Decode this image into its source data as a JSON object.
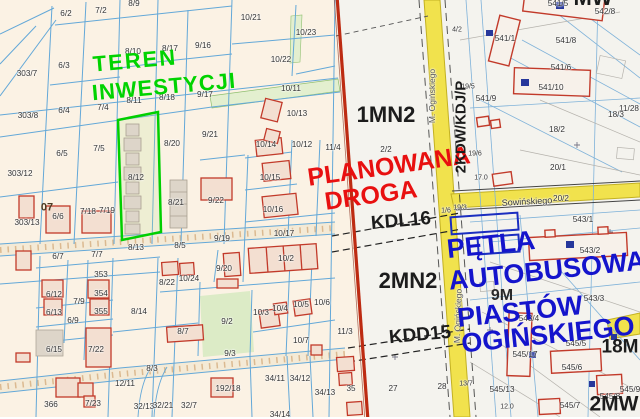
{
  "map": {
    "description": "Cadastral parcel map with zoning plan overlay",
    "colors": {
      "investment_green": "#00d300",
      "planned_road_red": "#e81010",
      "bus_loop_blue": "#1414cc",
      "road_yellow": "#f1e24d",
      "plan_boundary_red": "#bd2b12",
      "parcel_line_blue": "#63a8d8",
      "building_outline_red": "#c23a2a",
      "highlight_parcel_green": "#00cf00",
      "left_background": "#fbf2e4",
      "right_background": "#f4f3ee"
    }
  },
  "labels": {
    "zones": [
      {
        "t": "TEREN",
        "x": 135,
        "y": 61,
        "s": 22,
        "c": "#00d300",
        "r": -5,
        "b": 1,
        "ls": 2
      },
      {
        "t": "INWESTYCJI",
        "x": 164,
        "y": 87,
        "s": 22,
        "c": "#00d300",
        "r": -5,
        "b": 1,
        "ls": 1
      },
      {
        "t": "PLANOWANA",
        "x": 389,
        "y": 167,
        "s": 25,
        "c": "#e81010",
        "r": -8,
        "b": 1
      },
      {
        "t": "DROGA",
        "x": 371,
        "y": 196,
        "s": 25,
        "c": "#e81010",
        "r": -8,
        "b": 1
      },
      {
        "t": "PĘTLA",
        "x": 491,
        "y": 245,
        "s": 27,
        "c": "#1414cc",
        "r": -6,
        "b": 1
      },
      {
        "t": "AUTOBUSOWA",
        "x": 547,
        "y": 271,
        "s": 27,
        "c": "#1414cc",
        "r": -6,
        "b": 1
      },
      {
        "t": "PIASTÓW",
        "x": 520,
        "y": 312,
        "s": 27,
        "c": "#1414cc",
        "r": -6,
        "b": 1
      },
      {
        "t": "OGIŃSKIEGO",
        "x": 548,
        "y": 335,
        "s": 27,
        "c": "#1414cc",
        "r": -6,
        "b": 1
      },
      {
        "t": "1MN2",
        "x": 386,
        "y": 115,
        "s": 22,
        "c": "#1c1c1c",
        "b": 1
      },
      {
        "t": "2MN2",
        "x": 408,
        "y": 281,
        "s": 22,
        "c": "#1c1c1c",
        "b": 1
      },
      {
        "t": "KDL16",
        "x": 401,
        "y": 221,
        "s": 19,
        "c": "#1c1c1c",
        "r": -5,
        "b": 1
      },
      {
        "t": "KDD15",
        "x": 420,
        "y": 335,
        "s": 19,
        "c": "#1c1c1c",
        "r": -5,
        "b": 1
      },
      {
        "t": "2KDW/KDJ/P",
        "x": 461,
        "y": 127,
        "s": 15,
        "c": "#1c1c1c",
        "r": -90,
        "b": 1
      },
      {
        "t": "9M",
        "x": 502,
        "y": 296,
        "s": 16,
        "c": "#2a2a2a",
        "b": 1
      },
      {
        "t": "18M",
        "x": 620,
        "y": 347,
        "s": 19,
        "c": "#1c1c1c",
        "b": 1
      },
      {
        "t": "2MW",
        "x": 614,
        "y": 404,
        "s": 21,
        "c": "#1c1c1c",
        "b": 1
      },
      {
        "t": "MW",
        "x": 593,
        "y": -2,
        "s": 22,
        "c": "#1c1c1c",
        "b": 1
      },
      {
        "t": "07",
        "x": 47,
        "y": 208,
        "s": 11,
        "c": "#4a3a22",
        "b": 1
      }
    ],
    "streets": [
      {
        "t": "M. Ogińskiego",
        "x": 432,
        "y": 96,
        "r": -90,
        "s": 8.5,
        "c": "#555555"
      },
      {
        "t": "M. Ogińskiego",
        "x": 458,
        "y": 316,
        "r": -88,
        "s": 8.5,
        "c": "#555555"
      },
      {
        "t": "Sowińskiego",
        "x": 527,
        "y": 202,
        "r": -3,
        "s": 9,
        "c": "#333333"
      }
    ],
    "parcels": [
      {
        "t": "6/2",
        "x": 66,
        "y": 14
      },
      {
        "t": "7/2",
        "x": 101,
        "y": 11
      },
      {
        "t": "8/9",
        "x": 134,
        "y": 4
      },
      {
        "t": "303/7",
        "x": 27,
        "y": 74
      },
      {
        "t": "6/3",
        "x": 64,
        "y": 66
      },
      {
        "t": "8/10",
        "x": 133,
        "y": 52
      },
      {
        "t": "8/17",
        "x": 170,
        "y": 49
      },
      {
        "t": "9/16",
        "x": 203,
        "y": 46
      },
      {
        "t": "10/21",
        "x": 251,
        "y": 18
      },
      {
        "t": "10/23",
        "x": 306,
        "y": 33
      },
      {
        "t": "10/22",
        "x": 281,
        "y": 60
      },
      {
        "t": "303/8",
        "x": 28,
        "y": 116
      },
      {
        "t": "6/4",
        "x": 64,
        "y": 111
      },
      {
        "t": "7/4",
        "x": 103,
        "y": 108
      },
      {
        "t": "8/11",
        "x": 134,
        "y": 101
      },
      {
        "t": "8/18",
        "x": 167,
        "y": 98
      },
      {
        "t": "9/17",
        "x": 205,
        "y": 95
      },
      {
        "t": "10/11",
        "x": 291,
        "y": 89
      },
      {
        "t": "10/13",
        "x": 297,
        "y": 114
      },
      {
        "t": "303/12",
        "x": 20,
        "y": 174
      },
      {
        "t": "6/5",
        "x": 62,
        "y": 154
      },
      {
        "t": "7/5",
        "x": 99,
        "y": 149
      },
      {
        "t": "8/12",
        "x": 136,
        "y": 178
      },
      {
        "t": "9/21",
        "x": 210,
        "y": 135
      },
      {
        "t": "10/14",
        "x": 266,
        "y": 145
      },
      {
        "t": "10/12",
        "x": 302,
        "y": 145
      },
      {
        "t": "11/4",
        "x": 333,
        "y": 148
      },
      {
        "t": "8/20",
        "x": 172,
        "y": 144
      },
      {
        "t": "6/6",
        "x": 58,
        "y": 217
      },
      {
        "t": "303/13",
        "x": 27,
        "y": 223
      },
      {
        "t": "7/18",
        "x": 88,
        "y": 212
      },
      {
        "t": "7/19",
        "x": 107,
        "y": 211
      },
      {
        "t": "8/21",
        "x": 176,
        "y": 203
      },
      {
        "t": "9/22",
        "x": 216,
        "y": 201
      },
      {
        "t": "10/15",
        "x": 270,
        "y": 178
      },
      {
        "t": "10/16",
        "x": 273,
        "y": 210
      },
      {
        "t": "8/13",
        "x": 136,
        "y": 248
      },
      {
        "t": "6/7",
        "x": 58,
        "y": 257
      },
      {
        "t": "7/7",
        "x": 97,
        "y": 255
      },
      {
        "t": "353",
        "x": 101,
        "y": 275
      },
      {
        "t": "10/17",
        "x": 284,
        "y": 234
      },
      {
        "t": "9/19",
        "x": 222,
        "y": 239
      },
      {
        "t": "8/5",
        "x": 180,
        "y": 246
      },
      {
        "t": "9/20",
        "x": 224,
        "y": 269
      },
      {
        "t": "10/2",
        "x": 286,
        "y": 259
      },
      {
        "t": "6/12",
        "x": 54,
        "y": 295
      },
      {
        "t": "7/9",
        "x": 79,
        "y": 302
      },
      {
        "t": "354",
        "x": 101,
        "y": 294
      },
      {
        "t": "6/13",
        "x": 54,
        "y": 313
      },
      {
        "t": "355",
        "x": 101,
        "y": 312
      },
      {
        "t": "8/14",
        "x": 139,
        "y": 312
      },
      {
        "t": "6/9",
        "x": 73,
        "y": 321
      },
      {
        "t": "6/15",
        "x": 54,
        "y": 350
      },
      {
        "t": "7/22",
        "x": 96,
        "y": 350
      },
      {
        "t": "8/3",
        "x": 152,
        "y": 369
      },
      {
        "t": "12/11",
        "x": 125,
        "y": 384
      },
      {
        "t": "366",
        "x": 51,
        "y": 405
      },
      {
        "t": "7/23",
        "x": 93,
        "y": 404
      },
      {
        "t": "32/13",
        "x": 144,
        "y": 407
      },
      {
        "t": "32/21",
        "x": 163,
        "y": 406
      },
      {
        "t": "32/7",
        "x": 189,
        "y": 406
      },
      {
        "t": "8/22",
        "x": 167,
        "y": 283
      },
      {
        "t": "10/24",
        "x": 189,
        "y": 279
      },
      {
        "t": "9/2",
        "x": 227,
        "y": 322
      },
      {
        "t": "10/3",
        "x": 261,
        "y": 313
      },
      {
        "t": "10/4",
        "x": 280,
        "y": 309
      },
      {
        "t": "10/5",
        "x": 301,
        "y": 305
      },
      {
        "t": "10/6",
        "x": 322,
        "y": 303
      },
      {
        "t": "8/7",
        "x": 183,
        "y": 332
      },
      {
        "t": "10/7",
        "x": 301,
        "y": 341
      },
      {
        "t": "9/3",
        "x": 230,
        "y": 354
      },
      {
        "t": "192/18",
        "x": 228,
        "y": 389
      },
      {
        "t": "34/11",
        "x": 275,
        "y": 379
      },
      {
        "t": "34/12",
        "x": 300,
        "y": 379
      },
      {
        "t": "34/13",
        "x": 325,
        "y": 393
      },
      {
        "t": "34/14",
        "x": 280,
        "y": 415
      },
      {
        "t": "11/3",
        "x": 345,
        "y": 332
      },
      {
        "t": "35",
        "x": 351,
        "y": 389
      },
      {
        "t": "27",
        "x": 393,
        "y": 389
      },
      {
        "t": "28",
        "x": 442,
        "y": 387
      },
      {
        "t": "2/2",
        "x": 386,
        "y": 150
      },
      {
        "t": "541/1",
        "x": 505,
        "y": 39
      },
      {
        "t": "541/8",
        "x": 566,
        "y": 41
      },
      {
        "t": "541/6",
        "x": 561,
        "y": 68
      },
      {
        "t": "541/10",
        "x": 551,
        "y": 88
      },
      {
        "t": "541/9",
        "x": 486,
        "y": 99
      },
      {
        "t": "542/8",
        "x": 605,
        "y": 12
      },
      {
        "t": "541/5",
        "x": 558,
        "y": 4
      },
      {
        "t": "11/28",
        "x": 629,
        "y": 109
      },
      {
        "t": "18/3",
        "x": 616,
        "y": 115
      },
      {
        "t": "18/2",
        "x": 557,
        "y": 130
      },
      {
        "t": "20/1",
        "x": 558,
        "y": 168
      },
      {
        "t": "20/2",
        "x": 561,
        "y": 199
      },
      {
        "t": "543/1",
        "x": 583,
        "y": 220
      },
      {
        "t": "543/2",
        "x": 590,
        "y": 251
      },
      {
        "t": "543/3",
        "x": 594,
        "y": 299
      },
      {
        "t": "543/4",
        "x": 529,
        "y": 319
      },
      {
        "t": "545/5",
        "x": 576,
        "y": 344
      },
      {
        "t": "545/17",
        "x": 525,
        "y": 355
      },
      {
        "t": "545/6",
        "x": 572,
        "y": 368
      },
      {
        "t": "545/13",
        "x": 502,
        "y": 390
      },
      {
        "t": "545/7",
        "x": 570,
        "y": 406
      },
      {
        "t": "545/9",
        "x": 630,
        "y": 390
      },
      {
        "t": "545/8",
        "x": 610,
        "y": 397
      },
      {
        "t": "19/5",
        "x": 468,
        "y": 87,
        "s": 7
      },
      {
        "t": "19/6",
        "x": 475,
        "y": 154,
        "s": 7
      },
      {
        "t": "17.0",
        "x": 481,
        "y": 178,
        "s": 7
      },
      {
        "t": "19/3",
        "x": 460,
        "y": 208,
        "s": 7
      },
      {
        "t": "1/6",
        "x": 446,
        "y": 211,
        "s": 7
      },
      {
        "t": "4/2",
        "x": 457,
        "y": 30,
        "s": 7
      },
      {
        "t": "13/7",
        "x": 466,
        "y": 384,
        "s": 7
      },
      {
        "t": "12.0",
        "x": 507,
        "y": 407,
        "s": 7
      }
    ]
  }
}
